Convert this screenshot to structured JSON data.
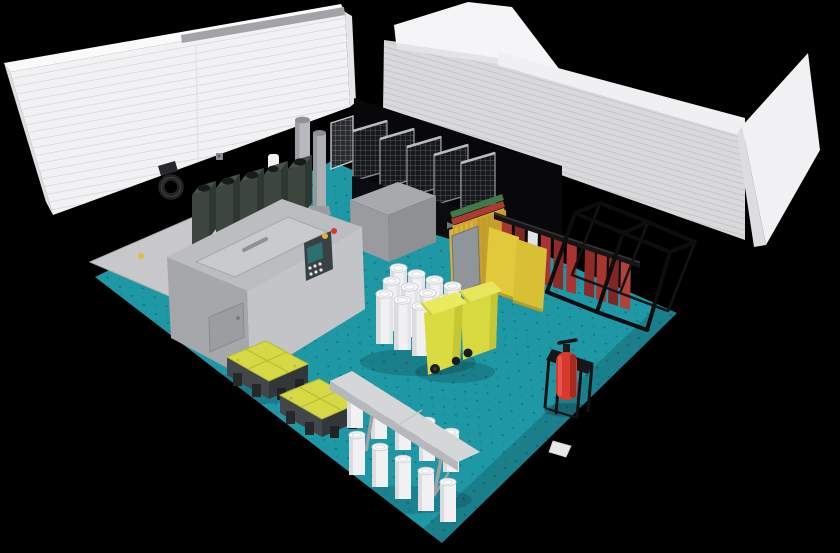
{
  "scene": {
    "title": "Isometric 3D render of a waste management room with exploded white panel walls",
    "background": "#000000",
    "floor": {
      "label": "teal perforated floor",
      "color": "#1f98a6",
      "dot_color": "#0b5b66",
      "pad_label": "concrete pad",
      "pad_color": "#c8c8ca"
    },
    "walls": {
      "left": {
        "label": "left ribbed sandwich-panel wall",
        "color": "#f2f2f4",
        "rib_color": "#dddde0",
        "top_color": "#fafafb",
        "rail_color": "#a2a3a6"
      },
      "right": {
        "label": "right ribbed sandwich-panel wall",
        "color": "#d9d9dc",
        "rib_color": "#c6c6ca",
        "cap_color": "#f0f0f2",
        "end_color": "#f1f1f3"
      }
    },
    "objects": [
      {
        "id": "green-bin-row",
        "label": "dark green waste bins",
        "count": 5,
        "color": "#3c463e"
      },
      {
        "id": "machine",
        "label": "gray processing machine with lid, hatch and control panel",
        "count": 1,
        "color": "#b4b5b8"
      },
      {
        "id": "chimney-pipes",
        "label": "exhaust pipes on machine rear",
        "count": 2,
        "color": "#b0b1b4"
      },
      {
        "id": "cage-trolleys",
        "label": "wire mesh cage trolleys on black bases",
        "count": 5,
        "color": "#17181b"
      },
      {
        "id": "backdrop-panel",
        "label": "black back panel",
        "count": 1,
        "color": "#08080a"
      },
      {
        "id": "bag-cart",
        "label": "cart with folded yellow big-bags",
        "count": 1,
        "color": "#d9b23a"
      },
      {
        "id": "hanging-rack",
        "label": "rail rack with hanging yellow and red panels",
        "count": 1,
        "color": "#e2c83b"
      },
      {
        "id": "cube-frame",
        "label": "black open pallet frame (2 cells)",
        "count": 1,
        "color": "#0d0d0f"
      },
      {
        "id": "fire-extinguisher",
        "label": "red fire extinguisher on black stand",
        "count": 1,
        "color": "#d9382e"
      },
      {
        "id": "yellow-bins",
        "label": "yellow wheelie bins",
        "count": 2,
        "color": "#d9da3f"
      },
      {
        "id": "drum-cluster",
        "label": "white drums, 3x4 group",
        "count": 12,
        "color": "#f1f1f3"
      },
      {
        "id": "spill-pallets",
        "label": "yellow spill containment pallets",
        "count": 2,
        "color": "#d6d944"
      },
      {
        "id": "shelf-table",
        "label": "gray shelf with stacked white drums beneath",
        "count": 1,
        "color": "#d5d6d8"
      },
      {
        "id": "wall-hook",
        "label": "wall-mounted hook ring",
        "count": 1,
        "color": "#2b2b2d"
      }
    ],
    "machine_panel": {
      "screen_color": "#2e6f72",
      "indicator_yellow": "#e0b52e",
      "indicator_red": "#cf3b30",
      "buttons": 6
    }
  },
  "palette": {
    "background": "#000000",
    "floor": "#1f98a6",
    "floor_shadow": "rgba(0,0,0,0.16)",
    "pad_gray": "#c8c8ca",
    "wall_left": "#f2f2f4",
    "wall_left_top": "#fafafb",
    "wall_right": "#d9d9dc",
    "wall_cap": "#f0f0f2",
    "wall_wedge": "#f5f5f7",
    "wall_end": "#f1f1f3",
    "panel_black": "#08080a",
    "machine_top": "#bcbdc0",
    "machine_front": "#a6a7aa",
    "machine_side": "#c3c4c7",
    "machine_lid": "#c9cacd",
    "machine_hatch": "#9c9da0",
    "panel_dark": "#394145",
    "screen_teal": "#2e6f72",
    "indicator_yellow": "#e0b52e",
    "indicator_red": "#cf3b30",
    "bin_green_front": "#3c463e",
    "bin_green_side": "#2e3832",
    "bin_green_top": "#47524a",
    "cage_dark": "#17181b",
    "cage_base": "#0b0c0d",
    "bag_yellow": "#d9b23a",
    "rack_yellow": "#e2c83b",
    "rack_yellow2": "#d9bf33",
    "rack_red": "#a93430",
    "frame_black": "#0d0d0f",
    "extinguisher_red": "#d9382e",
    "stand_black": "#17171a",
    "bin_yellow": "#dadb41",
    "bin_yellow_lid": "#e9ea5e",
    "drum_white": "#f1f1f3",
    "pallet_yellow": "#d6d944",
    "pallet_base": "#43464a",
    "table_gray": "#d5d6d8",
    "pipe_gray": "#b8b9bc",
    "rear_box": "#a8a9ac"
  }
}
